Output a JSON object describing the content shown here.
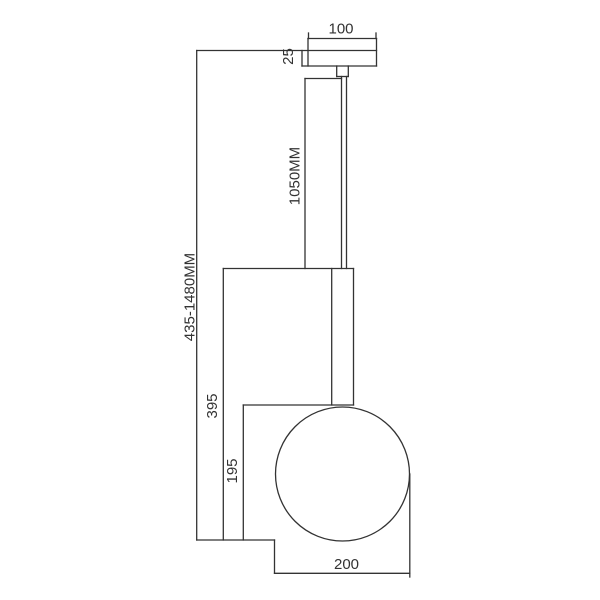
{
  "drawing": {
    "type": "pendant-lamp-dimension-diagram",
    "background_color": "#ffffff",
    "line_color": "#333333",
    "labels": {
      "canopy_width": "100",
      "canopy_height": "25",
      "rod_length": "1050MM",
      "overall_height": "435-1480MM",
      "body_height": "395",
      "shade_drop": "195",
      "globe_diameter": "200"
    }
  }
}
